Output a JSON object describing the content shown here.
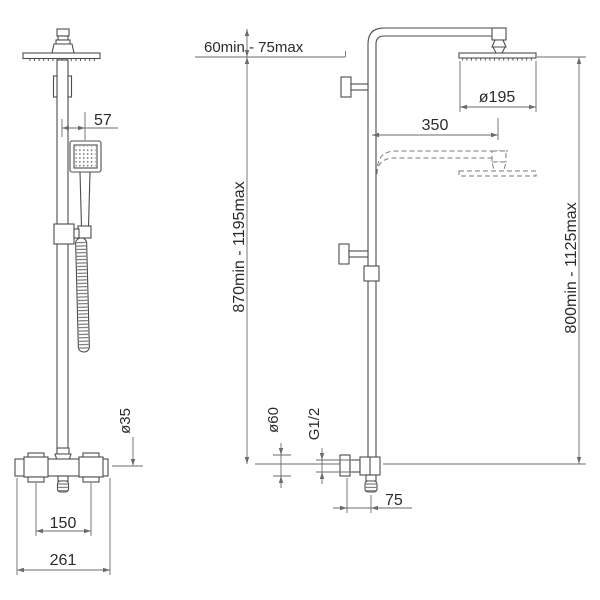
{
  "drawing": {
    "background": "#ffffff",
    "line_color": "#4d4d4d",
    "text_color": "#2b2b2b",
    "front_view": {
      "dimensions": {
        "handset_offset": "57",
        "pole_diameter": "ø35",
        "handle_spacing": "150",
        "valve_width": "261"
      }
    },
    "side_view": {
      "dimensions": {
        "top_adjustment_range": "60min - 75max",
        "height_range_left": "870min - 1195max",
        "height_range_right": "800min - 1125max",
        "head_diameter": "ø195",
        "arm_projection": "350",
        "escutcheon_diameter": "ø60",
        "inlet_thread": "G1/2",
        "inlet_offset": "75"
      }
    }
  }
}
